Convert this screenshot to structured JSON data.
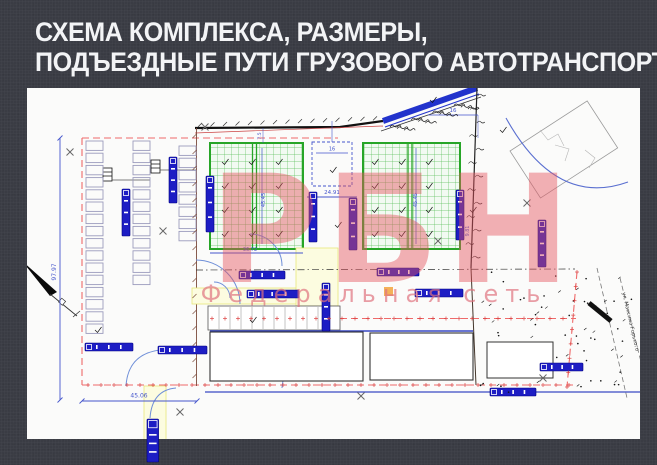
{
  "slide": {
    "title_line1": "СХЕМА КОМПЛЕКСА, РАЗМЕРЫ,",
    "title_line2": "ПОДЪЕЗДНЫЕ ПУТИ ГРУЗОВОГО АВТОТРАНСПОРТА"
  },
  "watermark": {
    "logo": "РБН",
    "tagline": "Федеральная сеть"
  },
  "plan": {
    "street_label": "ул. Максима Горького",
    "dims": {
      "site_height": "97.97",
      "site_width_left": "45.06",
      "gap_width": "24.91",
      "dock_width": "16",
      "top_right_width": "16",
      "building_a_width": "36.72",
      "building_depth": "45.45",
      "right_offset": "9.81",
      "top_offset": "7.5"
    },
    "colors": {
      "slide_background": "#3a3c44",
      "title_text": "#f3f4f6",
      "building_grid_green": "#27a527",
      "truck_blue": "#1d1dc4",
      "boundary_red": "#ef6a6a",
      "highway_blue": "#2233cc",
      "dimension_blue": "#4455cc",
      "watermark_pink": "#e4525e",
      "watermark_tagline_pink": "#df747f"
    }
  }
}
